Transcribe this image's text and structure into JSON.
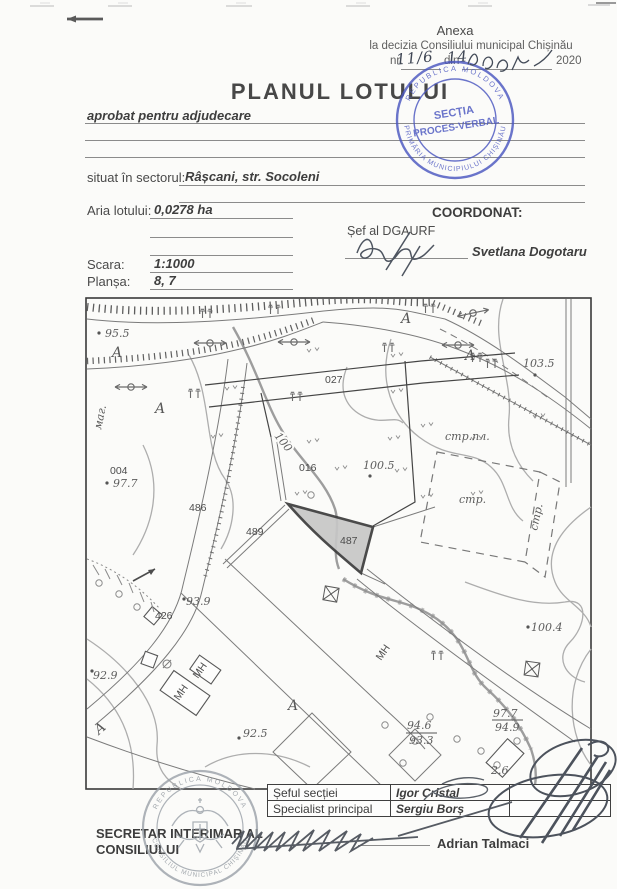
{
  "colors": {
    "paper": "#fbfbf9",
    "ink": "#4a4a4a",
    "stamp_blue": "#4b57c0",
    "stamp_gray": "#9aa1a8"
  },
  "header": {
    "anexa": "Anexa",
    "decision": "la decizia Consiliului municipal Chișinău",
    "nr_label": "nr.",
    "din_label": "din",
    "year": "2020",
    "nr_handwritten": "11/6",
    "day_handwritten": "14"
  },
  "title": "PLANUL LOTULUI",
  "form": {
    "approved": "aprobat pentru adjudecare",
    "sector_label": "situat  în sectorul:",
    "sector_value": "Râșcani, str. Socoleni",
    "area_label": "Aria lotului:",
    "area_value": "0,0278 ha",
    "scale_label": "Scara:",
    "scale_value": "1:1000",
    "sheet_label": "Planșa:",
    "sheet_value": "8, 7"
  },
  "coordination": {
    "coordonat": "COORDONAT:",
    "chief_title": "Șef al DGAURF",
    "chief_name": "Svetlana Dogotaru"
  },
  "stamp_blue": {
    "center_line1": "SECȚIA",
    "center_line2": "PROCES-VERBAL",
    "ring_top": "REPUBLICA MOLDOVA",
    "ring_bottom": "PRIMĂRIA MUNICIPIULUI CHIȘINĂU"
  },
  "stamp_gray": {
    "ring_top": "REPUBLICA MOLDOVA",
    "ring_bottom": "CONSILIUL MUNICIPAL CHIȘINĂU"
  },
  "approvals": {
    "rows": [
      {
        "role": "Șeful secției",
        "name": "Igor Cristal"
      },
      {
        "role": "Specialist principal",
        "name": "Sergiu Borș"
      }
    ]
  },
  "footer": {
    "secretary_line1": "SECRETAR INTERIMAR AL",
    "secretary_line2": "CONSILIULUI",
    "secretary_name": "Adrian Talmaci"
  },
  "map": {
    "labels": [
      {
        "text": "95.5"
      },
      {
        "text": "A"
      },
      {
        "text": "маг."
      },
      {
        "text": "A"
      },
      {
        "text": "A"
      },
      {
        "text": "A"
      },
      {
        "text": "103.5"
      },
      {
        "text": "027"
      },
      {
        "text": "100"
      },
      {
        "text": "016"
      },
      {
        "text": "100.5"
      },
      {
        "text": "стр.пл."
      },
      {
        "text": "стр."
      },
      {
        "text": "стр."
      },
      {
        "text": "004"
      },
      {
        "text": "97.7"
      },
      {
        "text": "486"
      },
      {
        "text": "489"
      },
      {
        "text": "487"
      },
      {
        "text": "426"
      },
      {
        "text": "93.9"
      },
      {
        "text": "92.9"
      },
      {
        "text": "92.5"
      },
      {
        "text": "100.4"
      },
      {
        "text": "MH"
      },
      {
        "text": "MH"
      },
      {
        "text": "MH"
      },
      {
        "text": "A"
      },
      {
        "text": "A"
      },
      {
        "text": "97.7"
      },
      {
        "text": "94.9"
      },
      {
        "text": "94.6"
      },
      {
        "text": "93.3"
      },
      {
        "text": "2.6"
      }
    ]
  }
}
